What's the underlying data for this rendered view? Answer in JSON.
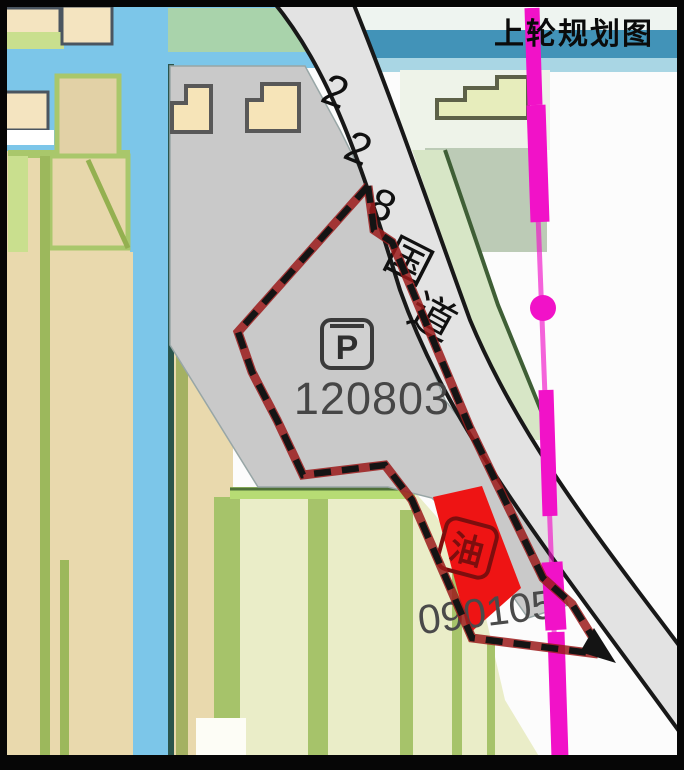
{
  "title": "上轮规划图",
  "road": {
    "name": "228国道",
    "chars": [
      "2",
      "2",
      "8",
      "国",
      "道"
    ]
  },
  "parcels": {
    "parking": {
      "code": "120803",
      "symbol": "P",
      "type": "parking-lot"
    },
    "gas_station": {
      "code": "090105",
      "symbol": "油",
      "type": "gas-station"
    }
  },
  "legend_colors": {
    "boundary_dash": "#141414",
    "boundary_underlay": "#9b1b1b",
    "planning_line_magenta": "#f112c8",
    "gas_station_red": "#ee1414",
    "parcel_gray": "#c9c9c9",
    "water_blue": "#7cc6e9",
    "field_tan": "#e9d9ad",
    "field_pale_green": "#eaedc8",
    "road_gray": "#e3e3e3",
    "teal_band": "#4293b8"
  }
}
